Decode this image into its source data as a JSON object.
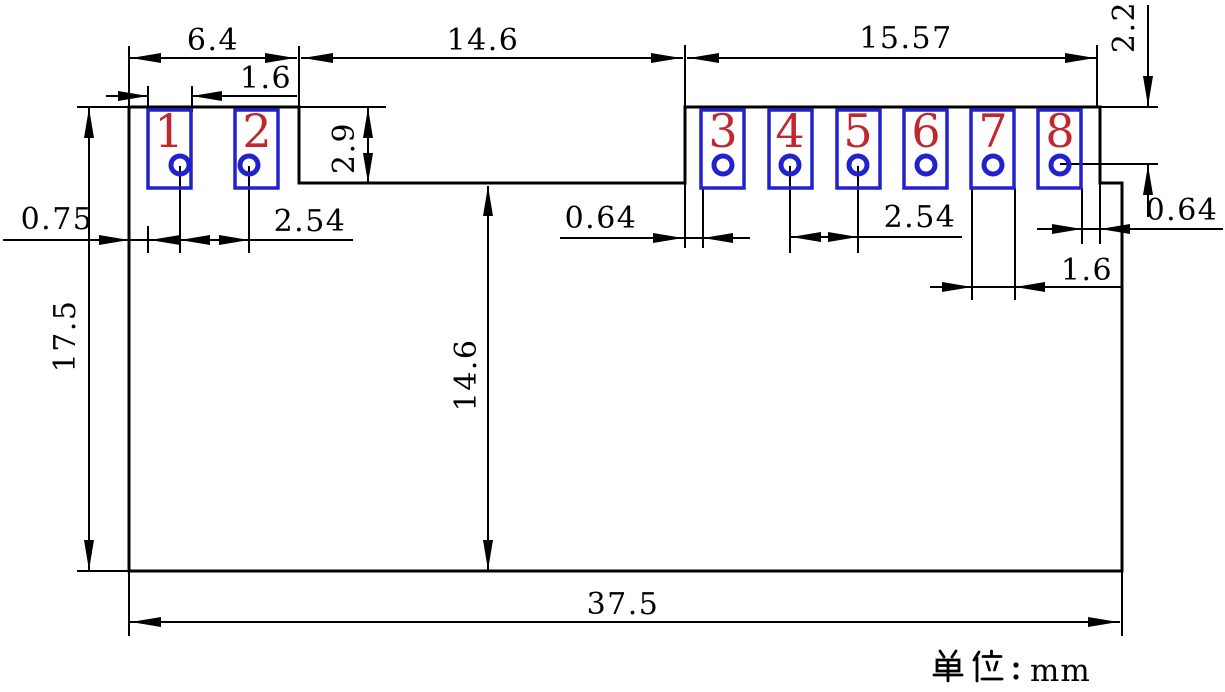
{
  "unit": {
    "label": "单位：mm",
    "prefix_cjk": "单位：",
    "value": "mm"
  },
  "pads": [
    {
      "number": "1"
    },
    {
      "number": "2"
    },
    {
      "number": "3"
    },
    {
      "number": "4"
    },
    {
      "number": "5"
    },
    {
      "number": "6"
    },
    {
      "number": "7"
    },
    {
      "number": "8"
    }
  ],
  "dimensions": {
    "top_left_width": "6.4",
    "pad1_width": "1.6",
    "notch_width": "14.6",
    "right_row_width": "15.57",
    "top_edge_to_pin_row": "2.2",
    "pad_height": "2.9",
    "left_edge_to_pad1": "0.75",
    "left_pin_pitch": "2.54",
    "notch_to_pad3": "0.64",
    "right_pin_pitch": "2.54",
    "pad8_to_right_edge": "0.64",
    "pad7_width": "1.6",
    "body_height": "17.5",
    "notch_bottom_to_bottom": "14.6",
    "body_width": "37.5"
  },
  "colors": {
    "line": "#000000",
    "pad_outline": "#2222cc",
    "pin_number": "#c1272d",
    "background": "#ffffff"
  }
}
